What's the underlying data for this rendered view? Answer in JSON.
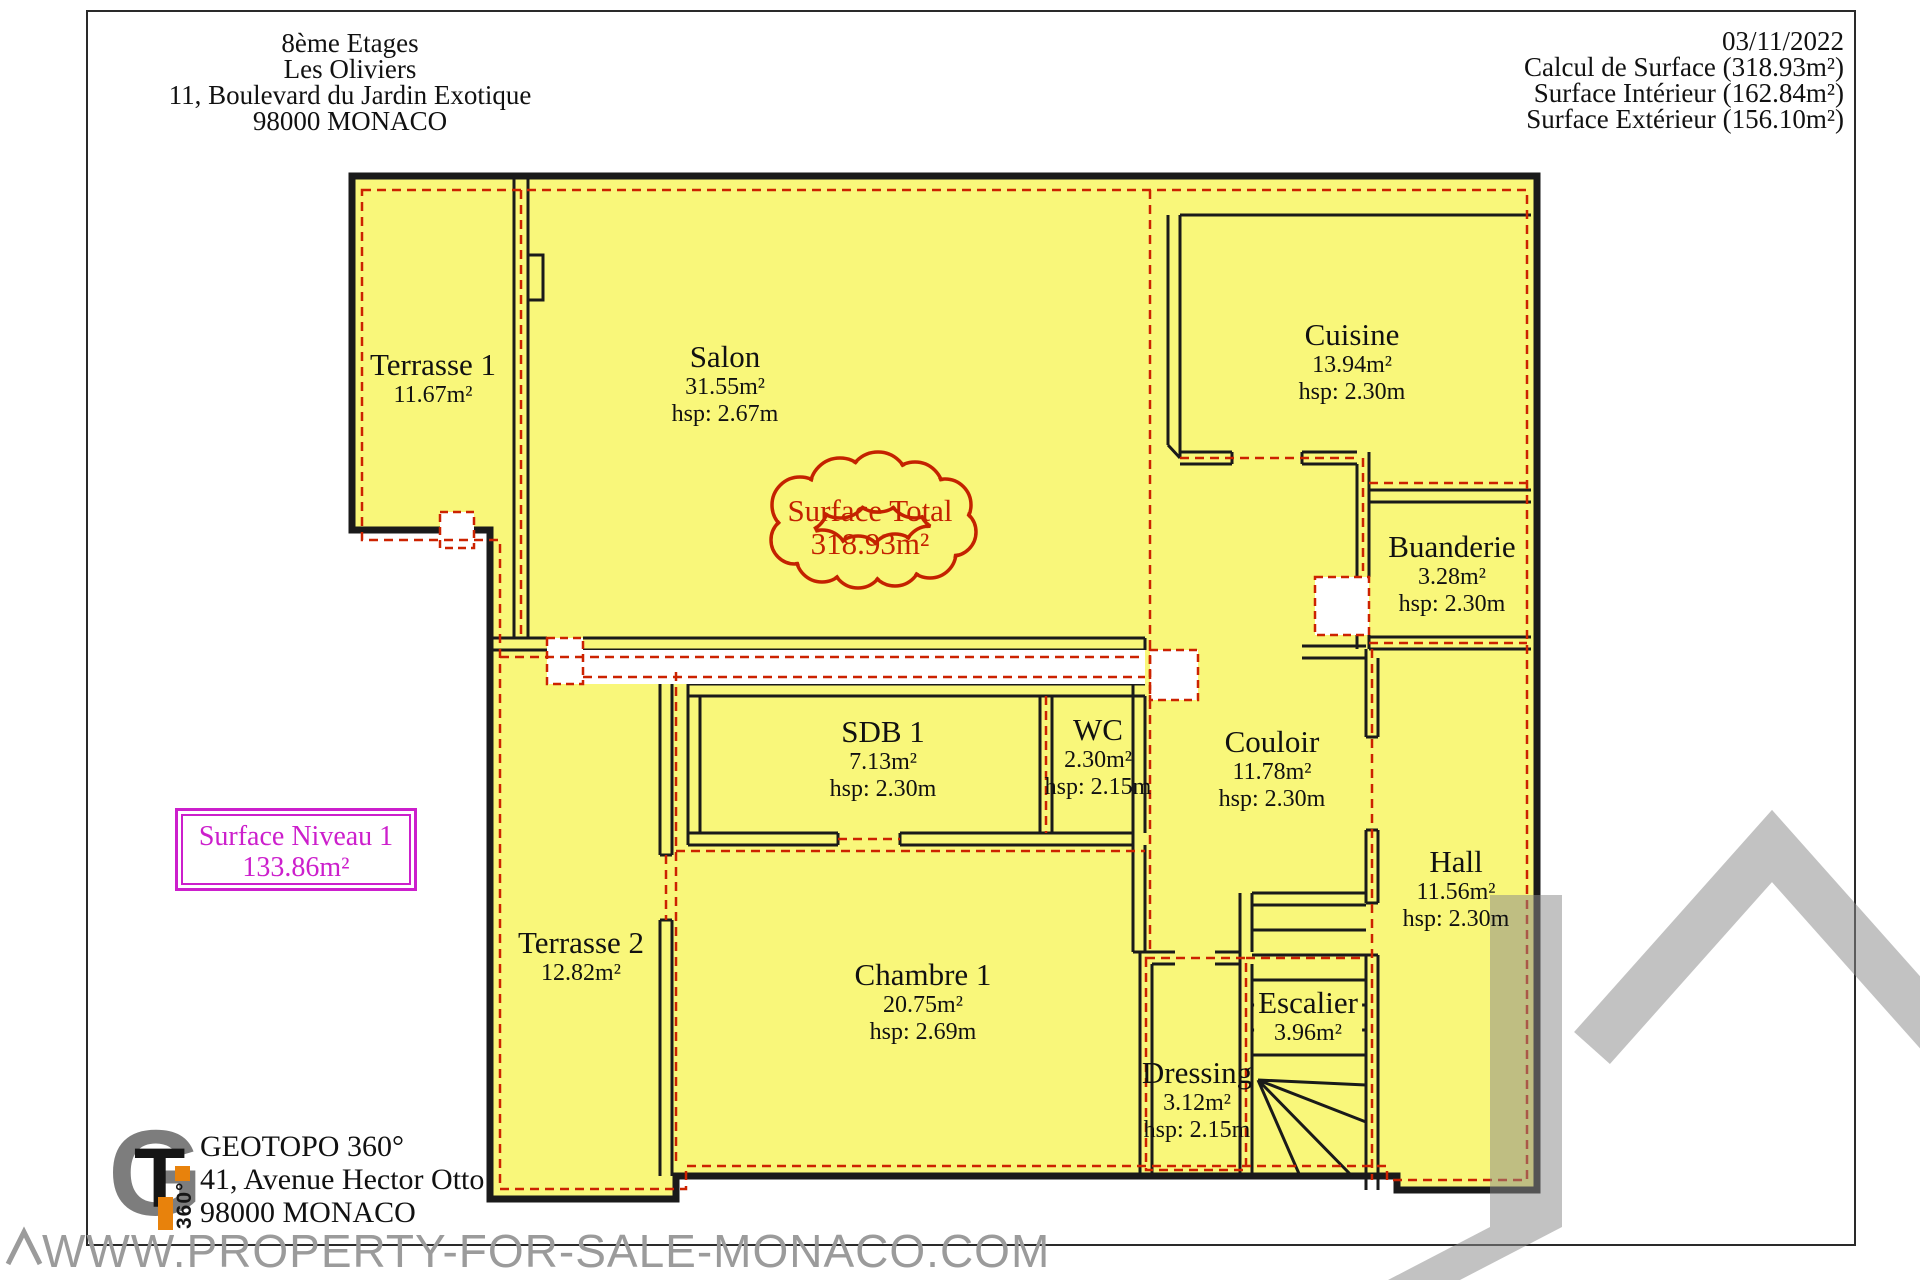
{
  "header_left": {
    "lines": [
      "8ème Etages",
      "Les Oliviers",
      "11, Boulevard du Jardin Exotique",
      "98000 MONACO"
    ]
  },
  "header_right": {
    "date": "03/11/2022",
    "lines": [
      "Calcul de Surface (318.93m²)",
      "Surface Intérieur (162.84m²)",
      "Surface Extérieur (156.10m²)"
    ]
  },
  "rooms": {
    "terrasse1": {
      "name": "Terrasse 1",
      "area": "11.67m²"
    },
    "salon": {
      "name": "Salon",
      "area": "31.55m²",
      "hsp": "hsp: 2.67m"
    },
    "cuisine": {
      "name": "Cuisine",
      "area": "13.94m²",
      "hsp": "hsp: 2.30m"
    },
    "buanderie": {
      "name": "Buanderie",
      "area": "3.28m²",
      "hsp": "hsp: 2.30m"
    },
    "sdb1": {
      "name": "SDB 1",
      "area": "7.13m²",
      "hsp": "hsp: 2.30m"
    },
    "wc": {
      "name": "WC",
      "area": "2.30m²",
      "hsp": "hsp: 2.15m"
    },
    "couloir": {
      "name": "Couloir",
      "area": "11.78m²",
      "hsp": "hsp: 2.30m"
    },
    "hall": {
      "name": "Hall",
      "area": "11.56m²",
      "hsp": "hsp: 2.30m"
    },
    "terrasse2": {
      "name": "Terrasse 2",
      "area": "12.82m²"
    },
    "chambre1": {
      "name": "Chambre 1",
      "area": "20.75m²",
      "hsp": "hsp: 2.69m"
    },
    "dressing": {
      "name": "Dressing",
      "area": "3.12m²",
      "hsp": "hsp: 2.15m"
    },
    "escalier": {
      "name": "Escalier",
      "area": "3.96m²"
    }
  },
  "badges": {
    "surface_total": {
      "title": "Surface Total",
      "value": "318.93m²"
    },
    "surface_niveau": {
      "title": "Surface Niveau 1",
      "value": "133.86m²"
    }
  },
  "footer": {
    "company": "GEOTOPO 360°",
    "address1": "41, Avenue Hector Otto",
    "address2": "98000 MONACO",
    "logo_g": "G",
    "logo_t": "T",
    "logo_360": "360°"
  },
  "watermark": {
    "url": "WWW.PROPERTY-FOR-SALE-MONACO.COM"
  },
  "colors": {
    "plan_fill": "#f9f77a",
    "wall": "#1a1a1a",
    "surface_dash": "#cc2200",
    "niveau_magenta": "#cc1fcc",
    "watermark_gray": "#8a8a8a",
    "logo_orange": "#e8820c"
  }
}
